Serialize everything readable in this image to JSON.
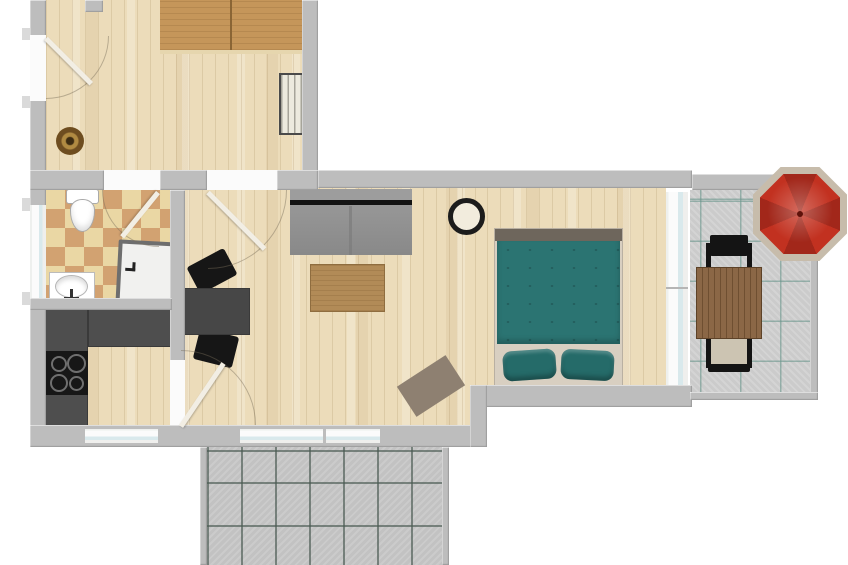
{
  "meta": {
    "description": "apartment-floor-plan-top-view",
    "view": "top-down-2d-render"
  },
  "palette": {
    "bg": "#ffffff",
    "wall": "#bdbdbd",
    "wallLight": "#dadada",
    "wood": "#ecdcba",
    "tileTan": "#d2a271",
    "tileBeige": "#ead7a4",
    "furnWood": "#c5965a",
    "radiator": "#eceade",
    "counter": "#4e4e4e",
    "stove": "#171717",
    "burnerRing": "#6f6f6f",
    "dineTable": "#474747",
    "chair": "#161616",
    "sofa": "#9d9d9d",
    "sofaLine": "#141414",
    "coffeeTable": "#b28b57",
    "lampRing": "#1c1c1c",
    "lampFace": "#f2ecdd",
    "rugLiving": "#8e8071",
    "bedFrame": "#d8cfc1",
    "bedStrip": "#6e665c",
    "duvet": "#2b7472",
    "pillow": "#256b69",
    "balconyTile": "#cbcbcb",
    "balconyGrid": "#7fa39b",
    "terraceTile": "#c2c2c2",
    "terraceGrid": "#5e6d65",
    "umbrellaRed": "#c23120",
    "umbrellaRedDark": "#a2271a",
    "umbrellaTrim": "#c7bcab",
    "outTableWood": "#8b6746",
    "outTableWoodDark": "#6f4f31",
    "outSeat": "#ccc4b2",
    "window": "#fbfbfb",
    "windowGlass": "#d9e9ec",
    "door": "#f2eee4",
    "showerFrame": "#6e6e6e",
    "showerFloor": "#f1f1ef"
  },
  "rooms": [
    {
      "id": "room-top-left",
      "floor": "wood"
    },
    {
      "id": "bathroom",
      "floor": "checker-tile"
    },
    {
      "id": "kitchen",
      "floor": "wood"
    },
    {
      "id": "living-dining-room",
      "floor": "wood"
    },
    {
      "id": "bedroom",
      "floor": "wood"
    },
    {
      "id": "balcony",
      "floor": "gray-tile"
    },
    {
      "id": "terrace",
      "floor": "gray-tile"
    }
  ],
  "furniture": {
    "room_top_left": [
      "wooden-bed-icon",
      "radiator-icon",
      "round-rug-icon",
      "entry-door-icon"
    ],
    "bathroom": [
      "toilet-icon",
      "washbasin-icon",
      "shower-icon"
    ],
    "kitchen": [
      "l-counter-icon",
      "cooktop-icon"
    ],
    "living_dining": [
      "sofa-icon",
      "coffee-table-icon",
      "pendant-lamp-icon",
      "dining-table-icon",
      "chair-icon",
      "chair-icon",
      "rug-icon"
    ],
    "bedroom": [
      "double-bed-icon",
      "pillow-icon",
      "pillow-icon"
    ],
    "balcony": [
      "parasol-icon",
      "outdoor-table-icon",
      "outdoor-chair-icon",
      "outdoor-chair-icon"
    ]
  }
}
